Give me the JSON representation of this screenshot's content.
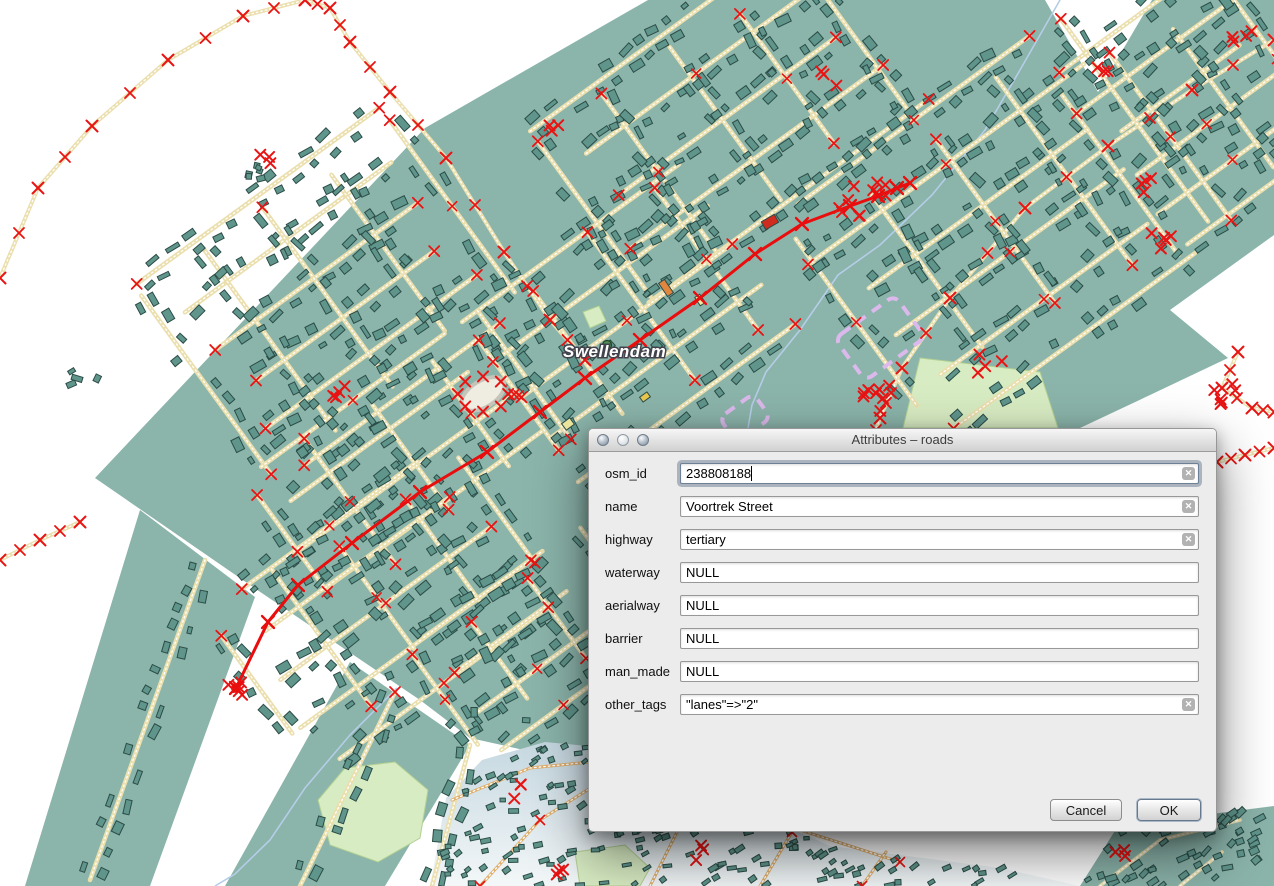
{
  "dialog": {
    "title": "Attributes – roads",
    "fields": [
      {
        "label": "osm_id",
        "value": "238808188",
        "clearable": true,
        "focused": true
      },
      {
        "label": "name",
        "value": "Voortrek Street",
        "clearable": true,
        "focused": false
      },
      {
        "label": "highway",
        "value": "tertiary",
        "clearable": true,
        "focused": false
      },
      {
        "label": "waterway",
        "value": "NULL",
        "clearable": false,
        "focused": false
      },
      {
        "label": "aerialway",
        "value": "NULL",
        "clearable": false,
        "focused": false
      },
      {
        "label": "barrier",
        "value": "NULL",
        "clearable": false,
        "focused": false
      },
      {
        "label": "man_made",
        "value": "NULL",
        "clearable": false,
        "focused": false
      },
      {
        "label": "other_tags",
        "value": "\"lanes\"=>\"2\"",
        "clearable": true,
        "focused": false
      }
    ],
    "buttons": {
      "cancel": "Cancel",
      "ok": "OK"
    },
    "clear_icon_glyph": "✕"
  },
  "map": {
    "place_label": "Swellendam",
    "colors": {
      "landuse": "#8bb4aa",
      "building": "#60958c",
      "building_stroke": "#2b4c46",
      "road": "#ebdfae",
      "road_dash": "#ffffff",
      "marker": "#e81414",
      "selected_road": "#ea0d0d",
      "water": "#b5cde7",
      "park": "#d8ecc3",
      "park_stroke": "#b2d093",
      "boundary": "#dcb9ec",
      "suburb_top": "#c6d8e1",
      "suburb_bottom": "#f3f7f8",
      "suburb_road": "#dfae6b",
      "label_fill": "#ffffff",
      "label_halo": "#42424c",
      "place_dot_fill": "#4f8d52",
      "place_dot_stroke": "#234425",
      "ring_fill": "#efede2",
      "ring_stroke": "#c6c4b8"
    },
    "landuse": {
      "main": [
        [
          425,
          128
        ],
        [
          648,
          0
        ],
        [
          1045,
          0
        ],
        [
          1098,
          92
        ],
        [
          1152,
          0
        ],
        [
          1274,
          0
        ],
        [
          1274,
          235
        ],
        [
          1170,
          310
        ],
        [
          1228,
          358
        ],
        [
          1150,
          395
        ],
        [
          1080,
          428
        ],
        [
          1055,
          530
        ],
        [
          660,
          770
        ],
        [
          560,
          758
        ],
        [
          470,
          738
        ],
        [
          420,
          700
        ],
        [
          250,
          585
        ],
        [
          95,
          478
        ]
      ],
      "arm_left": [
        [
          140,
          510
        ],
        [
          255,
          597
        ],
        [
          150,
          886
        ],
        [
          25,
          886
        ]
      ],
      "arm_right": [
        [
          350,
          662
        ],
        [
          470,
          745
        ],
        [
          385,
          886
        ],
        [
          225,
          886
        ]
      ],
      "bottom_right": [
        [
          1080,
          886
        ],
        [
          1118,
          826
        ],
        [
          1274,
          806
        ],
        [
          1274,
          886
        ]
      ]
    },
    "suburb": [
      [
        430,
        886
      ],
      [
        446,
        798
      ],
      [
        482,
        760
      ],
      [
        545,
        742
      ],
      [
        610,
        748
      ],
      [
        700,
        788
      ],
      [
        830,
        846
      ],
      [
        1000,
        868
      ],
      [
        1080,
        886
      ]
    ],
    "parks": [
      [
        [
          920,
          358
        ],
        [
          1040,
          372
        ],
        [
          1058,
          428
        ],
        [
          903,
          428
        ]
      ],
      [
        [
          318,
          800
        ],
        [
          345,
          768
        ],
        [
          395,
          762
        ],
        [
          428,
          790
        ],
        [
          420,
          838
        ],
        [
          378,
          862
        ],
        [
          330,
          845
        ]
      ],
      [
        [
          575,
          852
        ],
        [
          625,
          845
        ],
        [
          650,
          868
        ],
        [
          640,
          886
        ],
        [
          580,
          886
        ]
      ],
      [
        [
          583,
          312
        ],
        [
          599,
          306
        ],
        [
          606,
          321
        ],
        [
          590,
          328
        ]
      ]
    ],
    "water": [
      [
        [
          1060,
          0
        ],
        [
          1020,
          70
        ],
        [
          985,
          130
        ],
        [
          932,
          195
        ],
        [
          880,
          245
        ],
        [
          838,
          275
        ],
        [
          800,
          330
        ],
        [
          766,
          372
        ],
        [
          752,
          405
        ],
        [
          748,
          428
        ]
      ],
      [
        [
          397,
          688
        ],
        [
          350,
          735
        ],
        [
          305,
          788
        ],
        [
          270,
          840
        ],
        [
          235,
          874
        ],
        [
          215,
          886
        ]
      ]
    ],
    "rural_paths": [
      [
        [
          0,
          278
        ],
        [
          38,
          188
        ],
        [
          92,
          126
        ],
        [
          168,
          60
        ],
        [
          243,
          16
        ],
        [
          305,
          0
        ]
      ],
      [
        [
          305,
          0
        ],
        [
          330,
          8
        ],
        [
          350,
          42
        ],
        [
          390,
          92
        ],
        [
          446,
          158
        ],
        [
          504,
          252
        ],
        [
          550,
          320
        ],
        [
          585,
          360
        ]
      ],
      [
        [
          1274,
          40
        ],
        [
          1192,
          90
        ],
        [
          1108,
          146
        ],
        [
          1025,
          208
        ],
        [
          950,
          298
        ],
        [
          902,
          368
        ],
        [
          880,
          418
        ],
        [
          872,
          442
        ]
      ],
      [
        [
          1238,
          352
        ],
        [
          1222,
          388
        ],
        [
          1252,
          408
        ],
        [
          1274,
          412
        ]
      ],
      [
        [
          1217,
          462
        ],
        [
          1245,
          455
        ],
        [
          1274,
          448
        ]
      ],
      [
        [
          0,
          560
        ],
        [
          40,
          540
        ],
        [
          80,
          522
        ]
      ]
    ],
    "street_clusters": [
      {
        "cx": 330,
        "cy": 295,
        "w": 300,
        "h": 240,
        "a": -36,
        "sp": 48
      },
      {
        "cx": 730,
        "cy": 120,
        "w": 340,
        "h": 220,
        "a": -36,
        "sp": 52
      },
      {
        "cx": 625,
        "cy": 318,
        "w": 270,
        "h": 190,
        "a": -36,
        "sp": 50
      },
      {
        "cx": 990,
        "cy": 225,
        "w": 330,
        "h": 260,
        "a": -36,
        "sp": 55
      },
      {
        "cx": 1200,
        "cy": 115,
        "w": 200,
        "h": 230,
        "a": -36,
        "sp": 42
      },
      {
        "cx": 400,
        "cy": 465,
        "w": 260,
        "h": 160,
        "a": -36,
        "sp": 46
      },
      {
        "cx": 380,
        "cy": 595,
        "w": 300,
        "h": 170,
        "a": -36,
        "sp": 48
      },
      {
        "cx": 520,
        "cy": 645,
        "w": 180,
        "h": 120,
        "a": -36,
        "sp": 44
      }
    ],
    "arm_roads": [
      [
        [
          205,
          560
        ],
        [
          90,
          880
        ]
      ],
      [
        [
          395,
          692
        ],
        [
          300,
          886
        ]
      ],
      [
        [
          470,
          745
        ],
        [
          432,
          886
        ]
      ]
    ],
    "suburb_roads": [
      [
        [
          452,
          800
        ],
        [
          530,
          768
        ],
        [
          610,
          760
        ],
        [
          700,
          790
        ],
        [
          800,
          830
        ],
        [
          900,
          862
        ]
      ],
      [
        [
          480,
          886
        ],
        [
          540,
          820
        ],
        [
          600,
          782
        ]
      ],
      [
        [
          650,
          886
        ],
        [
          680,
          826
        ],
        [
          700,
          790
        ]
      ],
      [
        [
          760,
          886
        ],
        [
          792,
          832
        ]
      ],
      [
        [
          862,
          886
        ],
        [
          886,
          852
        ]
      ]
    ],
    "bottomright_roads": [
      [
        [
          1100,
          886
        ],
        [
          1160,
          840
        ],
        [
          1240,
          820
        ]
      ],
      [
        [
          1180,
          886
        ],
        [
          1222,
          852
        ]
      ]
    ],
    "selected_road": [
      [
        236,
        688
      ],
      [
        268,
        622
      ],
      [
        298,
        585
      ],
      [
        352,
        543
      ],
      [
        420,
        492
      ],
      [
        487,
        452
      ],
      [
        540,
        412
      ],
      [
        585,
        378
      ],
      [
        640,
        340
      ],
      [
        700,
        298
      ],
      [
        755,
        254
      ],
      [
        802,
        224
      ],
      [
        850,
        206
      ],
      [
        878,
        196
      ],
      [
        897,
        188
      ],
      [
        910,
        183
      ]
    ],
    "purple_zones": [
      {
        "x": 880,
        "y": 338,
        "w": 74,
        "h": 52,
        "a": -36
      },
      {
        "x": 745,
        "y": 418,
        "w": 42,
        "h": 30,
        "a": -36
      }
    ],
    "rings": [
      {
        "x": 483,
        "y": 394,
        "rx": 24,
        "ry": 13,
        "a": -32
      }
    ],
    "accent_buildings": [
      {
        "x": 770,
        "y": 222,
        "w": 15,
        "h": 9,
        "a": -30,
        "c": "#cf2b1e"
      },
      {
        "x": 666,
        "y": 288,
        "w": 16,
        "h": 7,
        "a": 56,
        "c": "#e0863f"
      },
      {
        "x": 645,
        "y": 397,
        "w": 9,
        "h": 6,
        "a": -36,
        "c": "#e8c84f"
      },
      {
        "x": 700,
        "y": 300,
        "w": 10,
        "h": 6,
        "a": 56,
        "c": "#efe8a0"
      },
      {
        "x": 568,
        "y": 424,
        "w": 10,
        "h": 8,
        "a": -36,
        "c": "#efe8a0"
      }
    ],
    "marker_clusters": [
      {
        "x": 877,
        "y": 398,
        "n": 9,
        "r": 14
      },
      {
        "x": 885,
        "y": 190,
        "n": 5,
        "r": 12
      },
      {
        "x": 236,
        "y": 688,
        "n": 5,
        "r": 8
      },
      {
        "x": 1225,
        "y": 395,
        "n": 6,
        "r": 14
      },
      {
        "x": 592,
        "y": 692,
        "n": 4,
        "r": 10
      },
      {
        "x": 556,
        "y": 128,
        "n": 3,
        "r": 8
      },
      {
        "x": 1105,
        "y": 62,
        "n": 3,
        "r": 10
      },
      {
        "x": 340,
        "y": 388,
        "n": 4,
        "r": 10
      },
      {
        "x": 1160,
        "y": 240,
        "n": 5,
        "r": 12
      },
      {
        "x": 265,
        "y": 160,
        "n": 3,
        "r": 8
      },
      {
        "x": 830,
        "y": 80,
        "n": 3,
        "r": 9
      },
      {
        "x": 990,
        "y": 360,
        "n": 4,
        "r": 14
      },
      {
        "x": 1240,
        "y": 35,
        "n": 4,
        "r": 12
      },
      {
        "x": 1150,
        "y": 185,
        "n": 4,
        "r": 12
      },
      {
        "x": 560,
        "y": 870,
        "n": 3,
        "r": 8
      },
      {
        "x": 1120,
        "y": 855,
        "n": 3,
        "r": 8
      },
      {
        "x": 610,
        "y": 800,
        "n": 3,
        "r": 10
      },
      {
        "x": 520,
        "y": 792,
        "n": 3,
        "r": 9
      },
      {
        "x": 700,
        "y": 852,
        "n": 3,
        "r": 9
      },
      {
        "x": 848,
        "y": 200,
        "n": 6,
        "r": 16
      }
    ],
    "stray_buildings": [
      {
        "x": 265,
        "y": 168,
        "n": 6,
        "r": 22
      },
      {
        "x": 85,
        "y": 378,
        "n": 4,
        "r": 14
      },
      {
        "x": 805,
        "y": 475,
        "n": 4,
        "r": 16
      },
      {
        "x": 500,
        "y": 720,
        "n": 5,
        "r": 30
      }
    ],
    "label_pos": [
      563,
      357
    ],
    "dot_pos": [
      607,
      345
    ]
  }
}
